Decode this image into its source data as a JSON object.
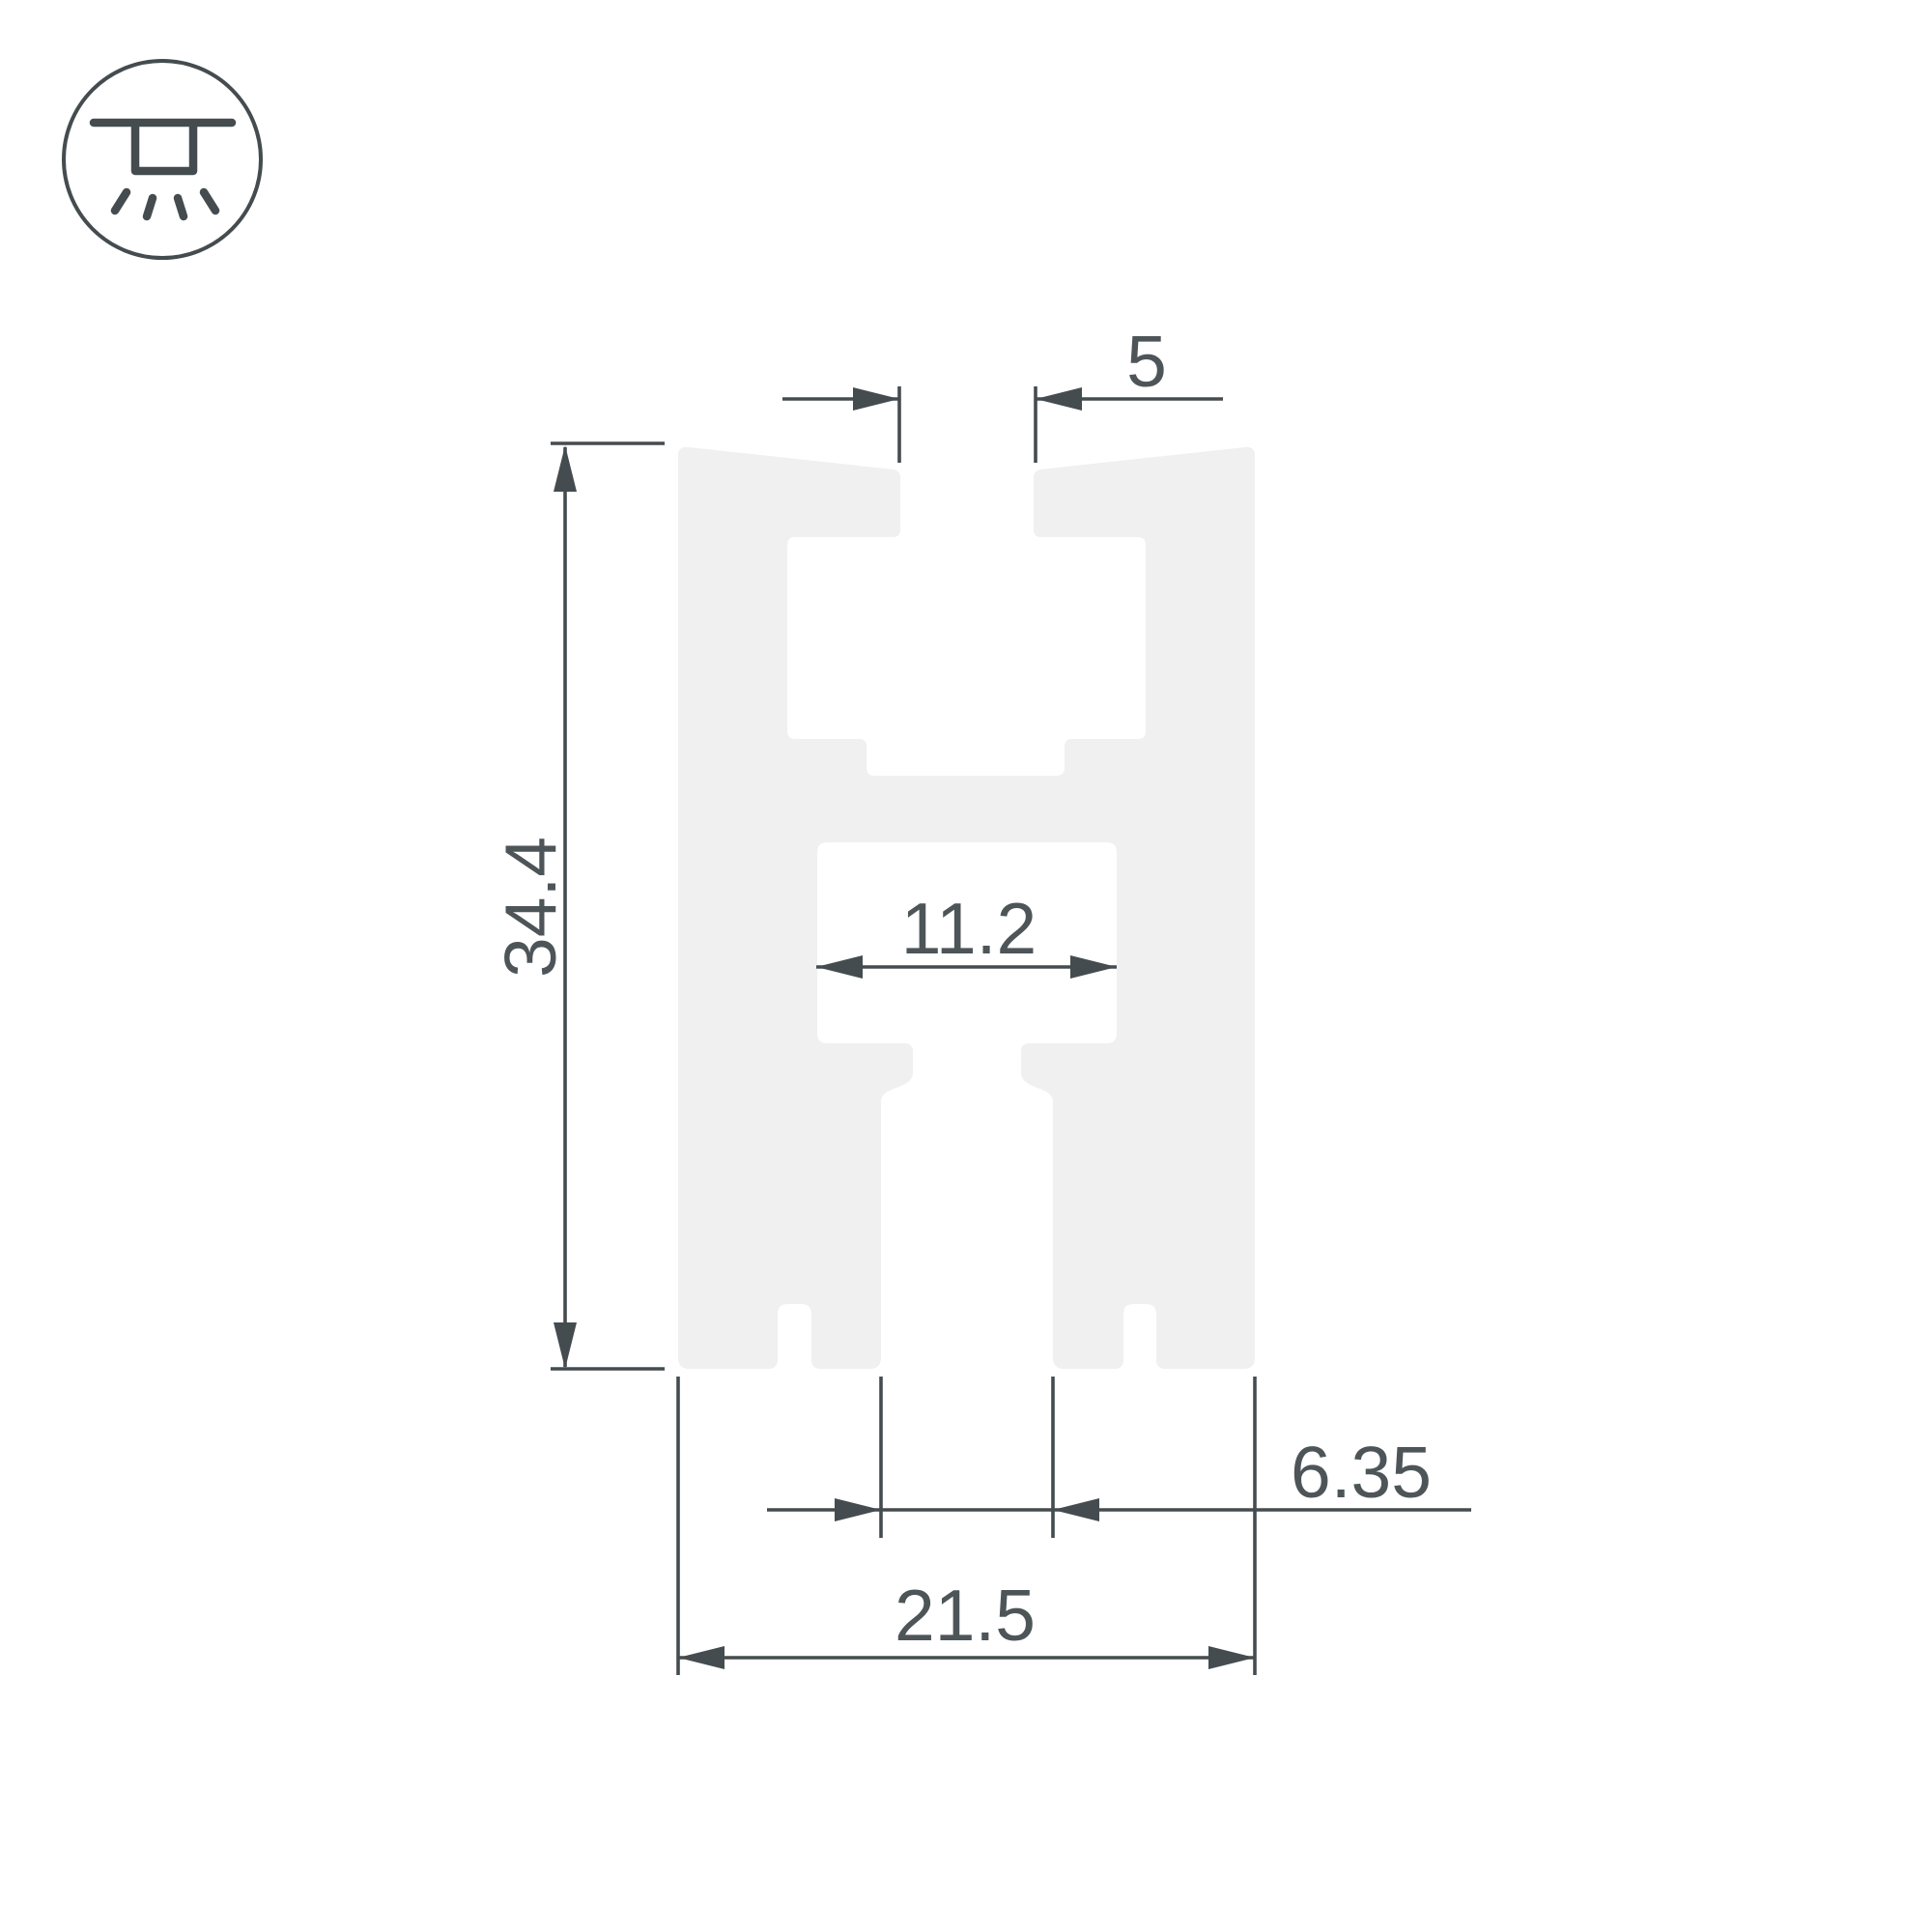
{
  "page": {
    "background": "#ffffff",
    "kind": "technical-drawing-screenshot"
  },
  "header_icon": {
    "name": "recessed-ceiling-light",
    "meaning": "ceiling recessed mounting type symbol"
  },
  "drawing": {
    "subject": "aluminium LED profile cross-section with hatched cut surfaces",
    "dimensions": {
      "top_slot_width": "5",
      "overall_height": "34.4",
      "inner_cavity_width": "11.2",
      "bottom_channel_width": "6.35",
      "overall_width": "21.5"
    }
  },
  "theme": {
    "line": "#454c4f",
    "text": "#4e5558",
    "fill": "#f0f0f0",
    "bg": "#ffffff"
  }
}
